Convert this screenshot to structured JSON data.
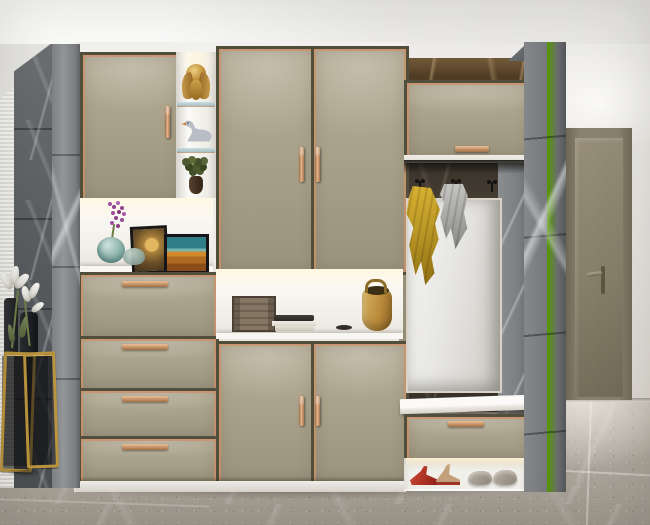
{
  "scene": {
    "domain": "natural-image",
    "description": "Modern entry hallway rendering: champagne lacquer storage wall with copper trim, gray marble pillars, coat alcove with mirror, bench and shoes, olive interior door"
  },
  "palette": {
    "cabinet_panel": "#a89f87",
    "cabinet_frame": "#514e3c",
    "copper_trim": "#c08a66",
    "carcass_white": "#f0eee9",
    "marble_gray_dark": "#595c5f",
    "marble_gray_light": "#8b8d90",
    "marble_brown": "#5e4b34",
    "wall_white": "#e9e7e2",
    "interior_door": "#887f6a",
    "floor_marble": "#b2aba0",
    "towel_yellow": "#c4a12e",
    "towel_gray": "#a3a3a1",
    "heels_red": "#b5372c",
    "handbag_tan": "#c9a254",
    "gold_accent": "#bb953e"
  },
  "cabinet": {
    "drawer_count": 4,
    "tall_door_count": 2,
    "bottom_door_count": 2,
    "display_shelf_items": [
      "gold lotus ornament",
      "swan figurine",
      "potted plant"
    ],
    "left_niche_items": [
      "purple flower sprig",
      "teal glass vase",
      "glass bowl",
      "framed moon artwork",
      "framed landscape artwork"
    ],
    "center_niche_items": [
      "wooden storage chest",
      "stack of books",
      "small dish",
      "tan leather handbag"
    ]
  },
  "alcove": {
    "hook_count": 3,
    "hanging": [
      "mustard yellow towel",
      "gray towel"
    ],
    "shoes": [
      "red high heels",
      "tan sandals",
      "gray suede loafers"
    ]
  },
  "labels": {
    "cabinet": "Champagne lacquer cabinet wall",
    "upper_left_door": "Upper cabinet door",
    "tall_doors": "Tall wardrobe doors",
    "bottom_doors": "Lower cabinet doors",
    "drawers": "Drawer stack",
    "display_shelf": "Display shelving",
    "left_niche": "Decor niche",
    "center_niche": "Open shelf niche",
    "overhead_cabinet": "Overhead flip-up cabinet",
    "mirror": "Dressing mirror",
    "coat_hooks": "Coat hooks",
    "towel_yellow": "Mustard towel",
    "towel_gray": "Gray towel",
    "bench": "Shoe bench drawer",
    "shoe_cubby": "Open shoe shelf",
    "interior_door": "Interior door",
    "marble_pillar": "Gray marble pillar",
    "console": "Brass console table",
    "lilies": "White lilies",
    "handbag": "Tan handbag",
    "swan": "Swan figurine",
    "ornament": "Gold lotus ornament"
  }
}
